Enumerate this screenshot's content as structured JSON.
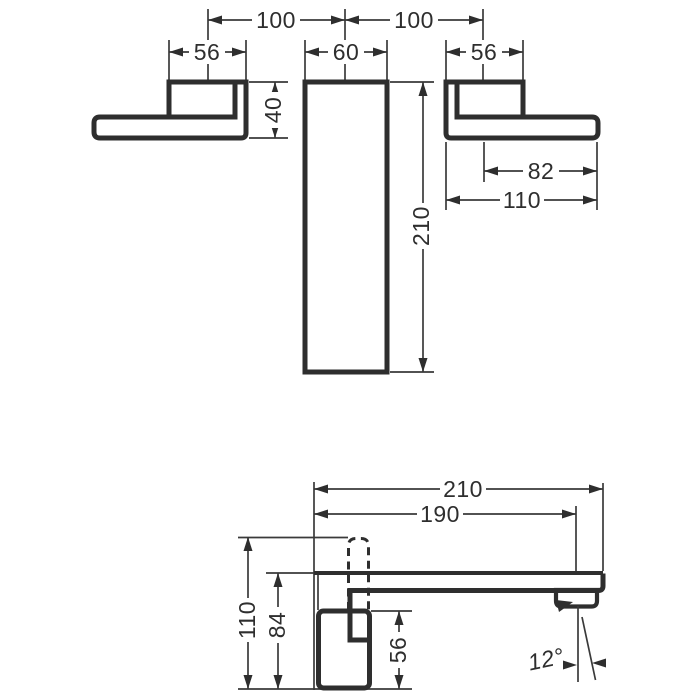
{
  "front_view": {
    "dim_spacing_left": "100",
    "dim_spacing_right": "100",
    "dim_left_handle_width": "56",
    "dim_plate_width": "60",
    "dim_right_handle_width": "56",
    "dim_handle_height": "40",
    "dim_plate_height": "210",
    "dim_lever_reach": "82",
    "dim_handle_length": "110"
  },
  "side_view": {
    "dim_spout_reach_total": "210",
    "dim_spout_reach_aerator": "190",
    "dim_height_total": "110",
    "dim_spout_height": "84",
    "dim_handle_height": "56",
    "dim_spray_angle": "12°"
  },
  "colors": {
    "line": "#2e2e2e",
    "background": "#ffffff"
  }
}
